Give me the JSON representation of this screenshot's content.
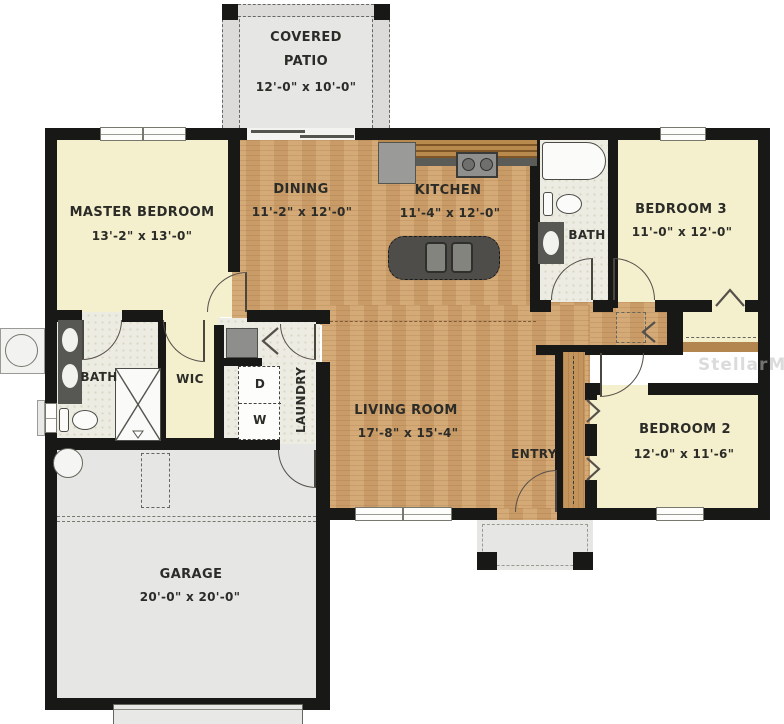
{
  "watermark": "StellarMLS",
  "rooms": {
    "patio": {
      "line1": "COVERED",
      "line2": "PATIO",
      "dims": "12'-0\" x 10'-0\""
    },
    "master": {
      "label": "MASTER BEDROOM",
      "dims": "13'-2\" x 13'-0\""
    },
    "dining": {
      "label": "DINING",
      "dims": "11'-2\" x 12'-0\""
    },
    "kitchen": {
      "label": "KITCHEN",
      "dims": "11'-4\" x 12'-0\""
    },
    "bath2": {
      "label": "BATH"
    },
    "bedroom3": {
      "label": "BEDROOM 3",
      "dims": "11'-0\" x 12'-0\""
    },
    "living": {
      "label": "LIVING ROOM",
      "dims": "17'-8\" x 15'-4\""
    },
    "entry": {
      "label": "ENTRY"
    },
    "master_bath": {
      "label": "BATH"
    },
    "wic": {
      "label": "WIC"
    },
    "laundry": {
      "label": "LAUNDRY",
      "dryer": "D",
      "washer": "W"
    },
    "bedroom2": {
      "label": "BEDROOM 2",
      "dims": "12'-0\" x 11'-6\""
    },
    "garage": {
      "label": "GARAGE",
      "dims": "20'-0\" x 20'-0\""
    }
  },
  "colors": {
    "wall": "#181817",
    "wood_floor": "#cfa26e",
    "carpet_cream": "#f4efcc",
    "tile": "#edece2",
    "concrete_gray": "#e6e6e4",
    "counter_dark": "#5b5b57",
    "cabinet_wood": "#a87840"
  }
}
